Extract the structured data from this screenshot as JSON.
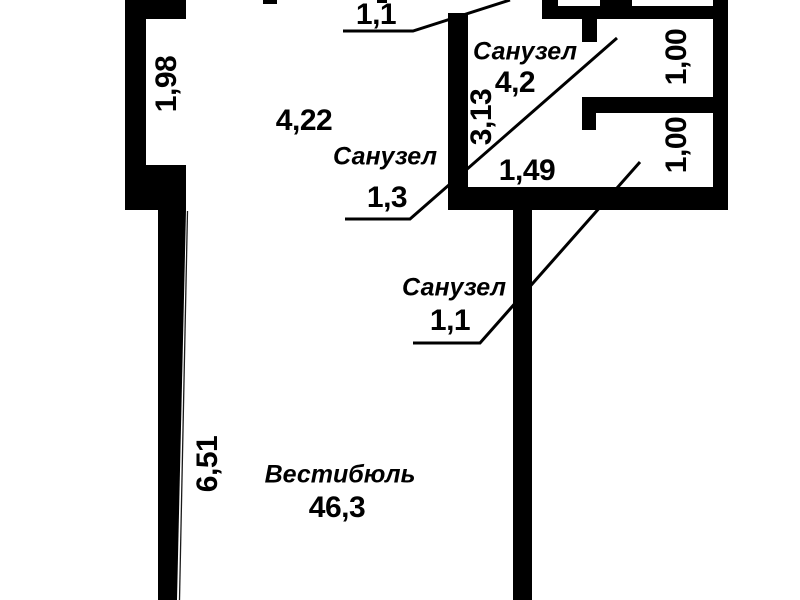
{
  "plan": {
    "background": "#ffffff",
    "wall_color": "#000000",
    "line_color": "#000000",
    "rooms": [
      {
        "name": "Санузел",
        "area": "4,2"
      },
      {
        "name": "Санузел",
        "area": "1,3"
      },
      {
        "name": "Санузел",
        "area": "1,1"
      },
      {
        "name": "Вестибюль",
        "area": "46,3"
      },
      {
        "name": "",
        "area": "1,1"
      }
    ],
    "dimensions": [
      "1,98",
      "4,22",
      "3,13",
      "1,49",
      "1,00",
      "1,00",
      "6,51"
    ]
  }
}
